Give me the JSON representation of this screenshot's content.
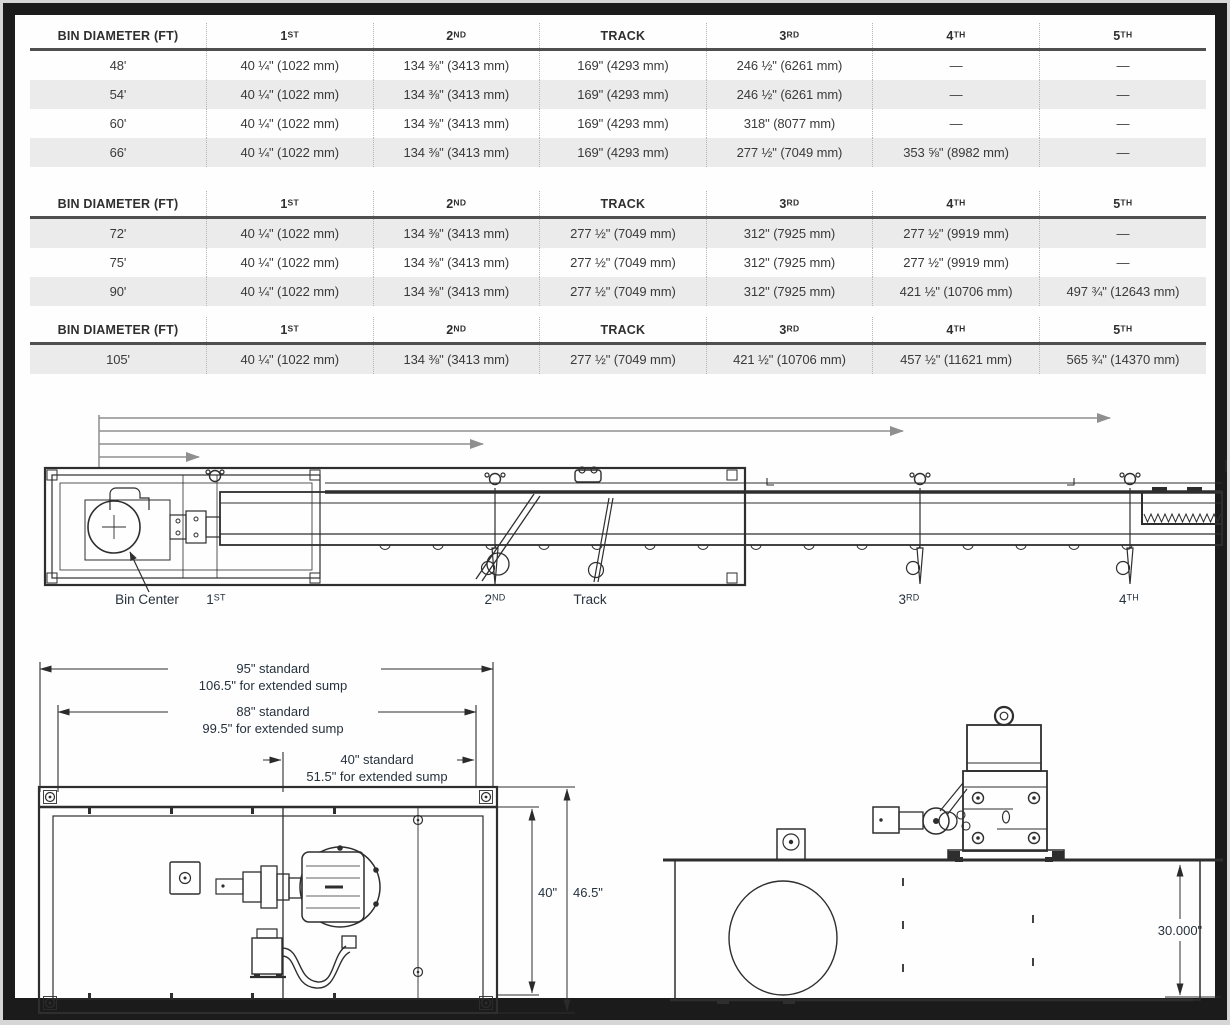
{
  "colors": {
    "frame": "#1b1b1b",
    "stripe": "#ebebeb",
    "header_rule": "#4f4f4f",
    "dotted_separator": "#b5b5b5",
    "table_text": "#3a3a3a",
    "drawing_label": "#26323e",
    "arrow_gray": "#8f8f8f",
    "line_dark": "#2e2e2e"
  },
  "tables": [
    {
      "headers": [
        "BIN DIAMETER (FT)",
        "1ST",
        "2ND",
        "TRACK",
        "3RD",
        "4TH",
        "5TH"
      ],
      "rows": [
        [
          "48'",
          "40 ¼\" (1022 mm)",
          "134 ⅜\" (3413 mm)",
          "169\" (4293 mm)",
          "246 ½\" (6261 mm)",
          "—",
          "—"
        ],
        [
          "54'",
          "40 ¼\" (1022 mm)",
          "134 ⅜\" (3413 mm)",
          "169\" (4293 mm)",
          "246 ½\" (6261 mm)",
          "—",
          "—"
        ],
        [
          "60'",
          "40 ¼\" (1022 mm)",
          "134 ⅜\" (3413 mm)",
          "169\" (4293 mm)",
          "318\" (8077 mm)",
          "—",
          "—"
        ],
        [
          "66'",
          "40 ¼\" (1022 mm)",
          "134 ⅜\" (3413 mm)",
          "169\" (4293 mm)",
          "277 ½\" (7049 mm)",
          "353 ⅝\" (8982 mm)",
          "—"
        ]
      ]
    },
    {
      "headers": [
        "BIN DIAMETER (FT)",
        "1ST",
        "2ND",
        "TRACK",
        "3RD",
        "4TH",
        "5TH"
      ],
      "rows": [
        [
          "72'",
          "40 ¼\" (1022 mm)",
          "134 ⅜\" (3413 mm)",
          "277 ½\" (7049 mm)",
          "312\" (7925 mm)",
          "277 ½\" (9919 mm)",
          "—"
        ],
        [
          "75'",
          "40 ¼\" (1022 mm)",
          "134 ⅜\" (3413 mm)",
          "277 ½\" (7049 mm)",
          "312\" (7925 mm)",
          "277 ½\" (9919 mm)",
          "—"
        ],
        [
          "90'",
          "40 ¼\" (1022 mm)",
          "134 ⅜\" (3413 mm)",
          "277 ½\" (7049 mm)",
          "312\" (7925 mm)",
          "421 ½\" (10706 mm)",
          "497 ¾\" (12643 mm)"
        ]
      ]
    },
    {
      "headers": [
        "BIN DIAMETER (FT)",
        "1ST",
        "2ND",
        "TRACK",
        "3RD",
        "4TH",
        "5TH"
      ],
      "rows": [
        [
          "105'",
          "40 ¼\" (1022 mm)",
          "134 ⅜\" (3413 mm)",
          "277 ½\" (7049 mm)",
          "421 ½\" (10706 mm)",
          "457 ½\" (11621 mm)",
          "565 ¾\" (14370 mm)"
        ]
      ]
    }
  ],
  "sweep_diagram": {
    "labels": {
      "bin_center": "Bin Center",
      "first": "1ST",
      "second": "2ND",
      "track": "Track",
      "third": "3RD",
      "fourth": "4TH"
    }
  },
  "plan_diagram": {
    "d95": "95\" standard",
    "d106": "106.5\" for extended sump",
    "d88": "88\" standard",
    "d99": "99.5\" for extended sump",
    "d40s": "40\" standard",
    "d51": "51.5\" for extended sump",
    "w40": "40\"",
    "w465": "46.5\""
  },
  "side_diagram": {
    "h30": "30.000\""
  }
}
